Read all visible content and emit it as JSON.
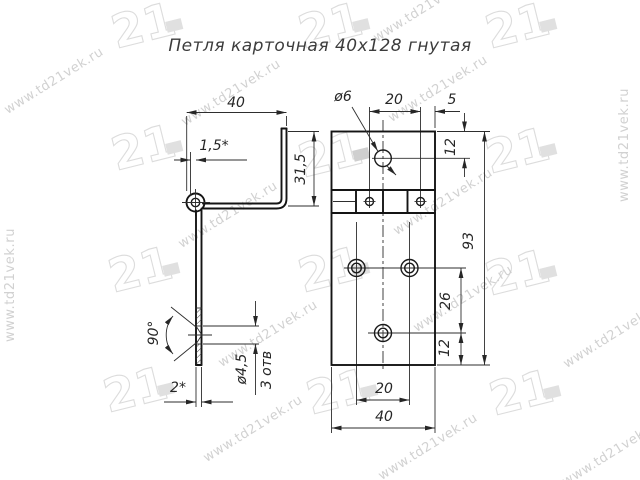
{
  "title": "Петля карточная 40х128 гнутая",
  "watermark": {
    "url_text": "www.td21vek.ru",
    "logo_text": "21"
  },
  "side_view": {
    "dim_width_top": "40",
    "dim_flange_thickness": "1,5*",
    "dim_flange_height": "31,5",
    "dim_countersink_angle": "90°",
    "dim_hole_diameter": "ø4,5",
    "dim_holes_count": "3 отв",
    "dim_leaf_thickness": "2*"
  },
  "front_view": {
    "dim_pin_hole_diameter": "ø6",
    "dim_pin_spacing": "20",
    "dim_pin_edge_offset": "5",
    "dim_top_hole_offset": "12",
    "dim_total_height": "93",
    "dim_lower_holes_spacing": "26",
    "dim_bottom_hole_offset": "12",
    "dim_holes_spacing_x": "20",
    "dim_width_bottom": "40"
  }
}
